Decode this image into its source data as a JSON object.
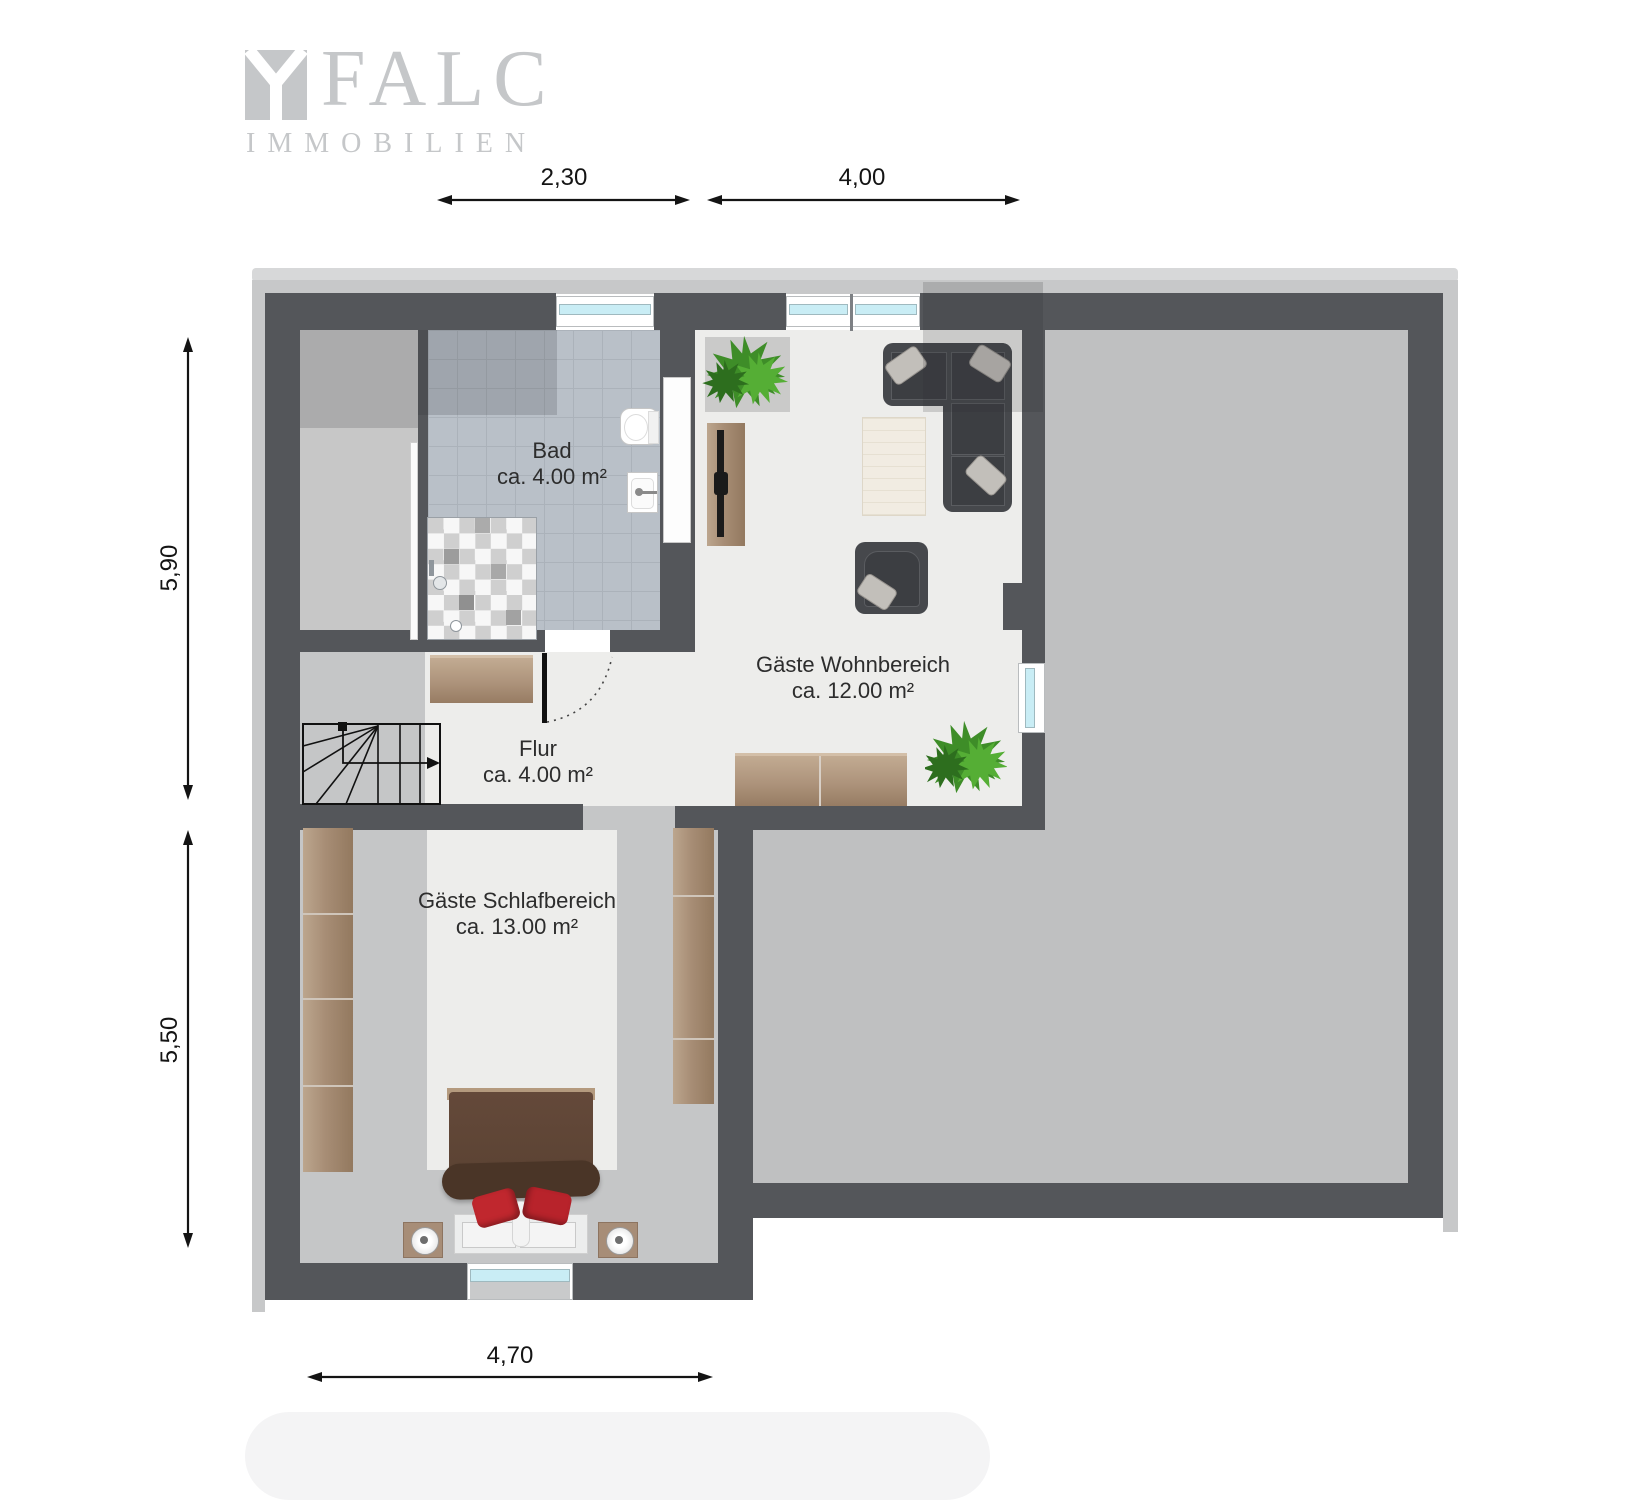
{
  "logo": {
    "brand": "FALC",
    "subtitle": "IMMOBILIEN"
  },
  "dimensions": {
    "top_left": "2,30",
    "top_right": "4,00",
    "left_upper": "5,90",
    "left_lower": "5,50",
    "bottom": "4,70"
  },
  "rooms": {
    "bad": {
      "name": "Bad",
      "area": "ca. 4.00 m²"
    },
    "wohnbereich": {
      "name": "Gäste Wohnbereich",
      "area": "ca. 12.00 m²"
    },
    "flur": {
      "name": "Flur",
      "area": "ca. 4.00 m²"
    },
    "schlafbereich": {
      "name": "Gäste Schlafbereich",
      "area": "ca. 13.00 m²"
    }
  },
  "colors": {
    "wall": "#54565a",
    "roof_band": "#c7c8c9",
    "floor_light": "#ededeb",
    "floor_big_room": "#bfc0c1",
    "slope_band": "#c5c6c7",
    "bath_tile": "#b9c0c8",
    "window_glass": "#c9edf5",
    "wood": "#ab9179",
    "sofa_dark": "#46484c",
    "bed_red_pillow": "#c0272e",
    "plant_green": "#46a02e",
    "logo_gray": "#c5c7c9",
    "dimension_ink": "#141414"
  }
}
